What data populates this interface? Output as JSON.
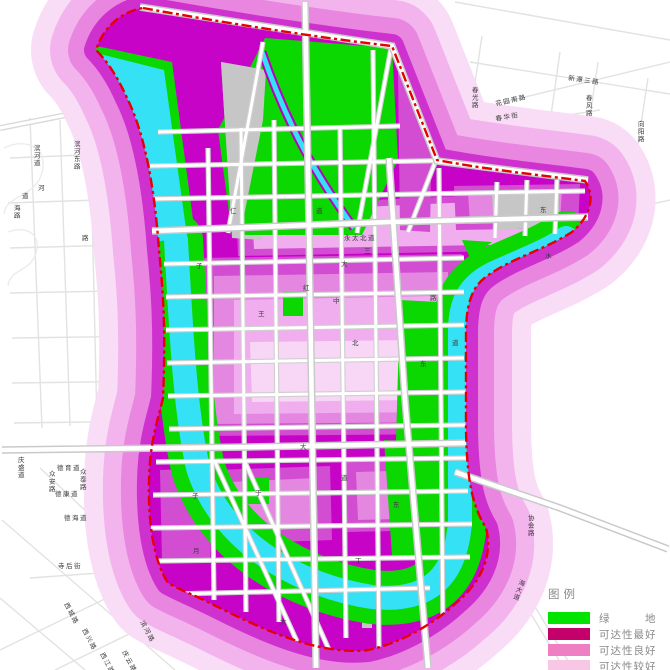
{
  "legend": {
    "title": "图例",
    "items": [
      {
        "name": "green-space",
        "label": "绿　　　地",
        "color": "#00e400"
      },
      {
        "name": "accessibility-best",
        "label": "可达性最好",
        "color": "#c4006a"
      },
      {
        "name": "accessibility-good",
        "label": "可达性良好",
        "color": "#ef7fc3"
      },
      {
        "name": "accessibility-fair",
        "label": "可达性较好",
        "color": "#f8c7e6"
      }
    ]
  },
  "palette": {
    "green": "#0bd800",
    "water": "#35e1f4",
    "best": "#c803c8",
    "shade1": "#d24dd2",
    "shade2": "#e487e0",
    "shade3": "#f0aeee",
    "shade4": "#f8d6f6",
    "ring1": "#f9dcf6",
    "ring2": "#f3b4ee",
    "ring3": "#e886e0",
    "ring4": "#cf31cf",
    "gray": "#c6c6c6",
    "casing": "#cfcfcf",
    "boundary": "#e60000",
    "bgroad": "#e2e2e2",
    "maplabel": "#3a3a3a"
  },
  "road_labels": [
    {
      "t": "花园南路",
      "x": 496,
      "y": 106,
      "r": -13
    },
    {
      "t": "新潭三路",
      "x": 568,
      "y": 80,
      "r": 8
    },
    {
      "t": "春光路",
      "x": 472,
      "y": 92,
      "v": 1
    },
    {
      "t": "春华街",
      "x": 496,
      "y": 121,
      "r": -10
    },
    {
      "t": "春风路",
      "x": 586,
      "y": 100,
      "v": 1
    },
    {
      "t": "向阳路",
      "x": 638,
      "y": 126,
      "v": 1
    },
    {
      "t": "滨河道",
      "x": 34,
      "y": 150,
      "v": 1
    },
    {
      "t": "滨河东路",
      "x": 74,
      "y": 146,
      "v": 1
    },
    {
      "t": "海路",
      "x": 14,
      "y": 210,
      "v": 1
    },
    {
      "t": "河",
      "x": 38,
      "y": 190
    },
    {
      "t": "道",
      "x": 22,
      "y": 198
    },
    {
      "t": "路",
      "x": 82,
      "y": 240
    },
    {
      "t": "庆盛道",
      "x": 18,
      "y": 462,
      "v": 1
    },
    {
      "t": "德育道",
      "x": 57,
      "y": 470
    },
    {
      "t": "众安路",
      "x": 49,
      "y": 476,
      "v": 1
    },
    {
      "t": "众泰路",
      "x": 80,
      "y": 474,
      "v": 1
    },
    {
      "t": "德康道",
      "x": 55,
      "y": 496
    },
    {
      "t": "德海道",
      "x": 64,
      "y": 520
    },
    {
      "t": "寺后街",
      "x": 58,
      "y": 568
    },
    {
      "t": "西城路",
      "x": 64,
      "y": 604,
      "r": 62
    },
    {
      "t": "西兴路",
      "x": 82,
      "y": 630,
      "r": 62
    },
    {
      "t": "西江路",
      "x": 100,
      "y": 654,
      "r": 62
    },
    {
      "t": "庆云路",
      "x": 122,
      "y": 652,
      "r": 62
    },
    {
      "t": "滨河路",
      "x": 140,
      "y": 622,
      "r": 62
    },
    {
      "t": "协会路",
      "x": 528,
      "y": 520,
      "v": 1
    },
    {
      "t": "海大道",
      "x": 518,
      "y": 584,
      "v": 1,
      "r": 20
    },
    {
      "t": "永太北道",
      "x": 344,
      "y": 240
    },
    {
      "t": "三",
      "x": 364,
      "y": 253
    },
    {
      "t": "大",
      "x": 341,
      "y": 266
    },
    {
      "t": "中",
      "x": 333,
      "y": 303
    },
    {
      "t": "红",
      "x": 303,
      "y": 290
    },
    {
      "t": "王",
      "x": 258,
      "y": 316
    },
    {
      "t": "仁",
      "x": 230,
      "y": 213
    },
    {
      "t": "道",
      "x": 316,
      "y": 213
    },
    {
      "t": "子",
      "x": 196,
      "y": 268
    },
    {
      "t": "子",
      "x": 192,
      "y": 498
    },
    {
      "t": "月",
      "x": 193,
      "y": 553
    },
    {
      "t": "于",
      "x": 255,
      "y": 495
    },
    {
      "t": "北",
      "x": 352,
      "y": 345
    },
    {
      "t": "东",
      "x": 420,
      "y": 366
    },
    {
      "t": "东",
      "x": 393,
      "y": 507
    },
    {
      "t": "道",
      "x": 341,
      "y": 480
    },
    {
      "t": "大",
      "x": 280,
      "y": 624
    },
    {
      "t": "丁",
      "x": 355,
      "y": 563
    },
    {
      "t": "水",
      "x": 545,
      "y": 258
    },
    {
      "t": "东",
      "x": 540,
      "y": 212
    },
    {
      "t": "路",
      "x": 430,
      "y": 300
    },
    {
      "t": "道",
      "x": 452,
      "y": 345
    },
    {
      "t": "大",
      "x": 300,
      "y": 449
    }
  ]
}
